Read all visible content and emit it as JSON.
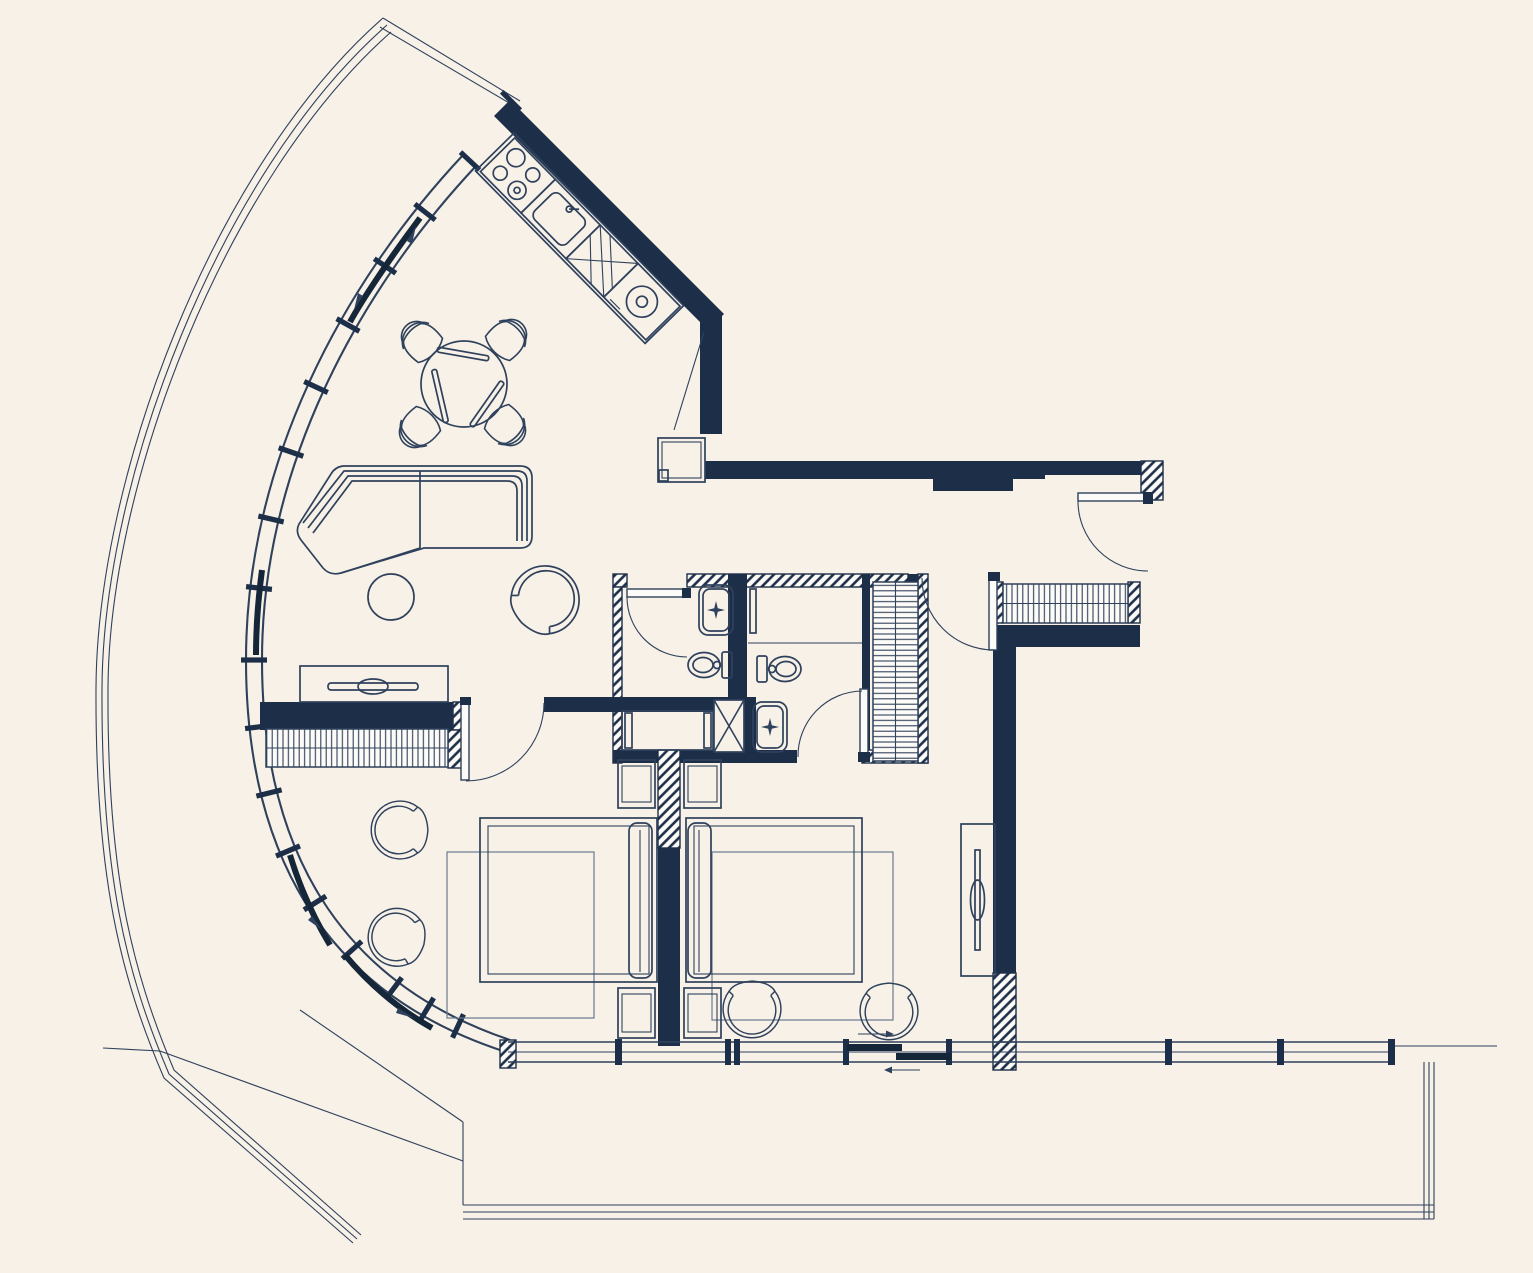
{
  "meta": {
    "kind": "architectural-floor-plan",
    "style": "blueprint line drawing, dark navy on cream, no text labels visible"
  },
  "colors": {
    "background": "#f7f1e7",
    "wall": "#1d2e48",
    "line": "#2f415c",
    "line_light": "#6b7a90",
    "rail": "#142638",
    "paper": "#fdfbf7"
  },
  "plan": {
    "rooms": [
      {
        "name": "living-dining-kitchen"
      },
      {
        "name": "entry-hallway"
      },
      {
        "name": "bathroom-1"
      },
      {
        "name": "bathroom-2"
      },
      {
        "name": "bedroom-1"
      },
      {
        "name": "bedroom-2"
      },
      {
        "name": "curved-terrace"
      },
      {
        "name": "lower-terrace"
      }
    ],
    "fixtures": [
      "curved-glass-facade",
      "sliding-window-rails",
      "entry-door",
      "bedroom-1-door",
      "bedroom-2-door",
      "bathroom-1-door",
      "bathroom-2-door",
      "kitchen-counter",
      "stove",
      "kitchen-sink",
      "drainer",
      "washer",
      "fridge",
      "dining-table",
      "dining-chairs",
      "sofa",
      "ottoman",
      "armchair",
      "tv-console",
      "wardrobe-bedroom-1",
      "wardrobe-bedroom-2",
      "entry-wardrobe",
      "bed-1",
      "bed-2",
      "nightstands",
      "rugs",
      "toilets",
      "wash-basins",
      "shower-1",
      "shower-2",
      "service-duct",
      "tall-cabinet",
      "window-wall-south",
      "sliding-door-south"
    ]
  }
}
